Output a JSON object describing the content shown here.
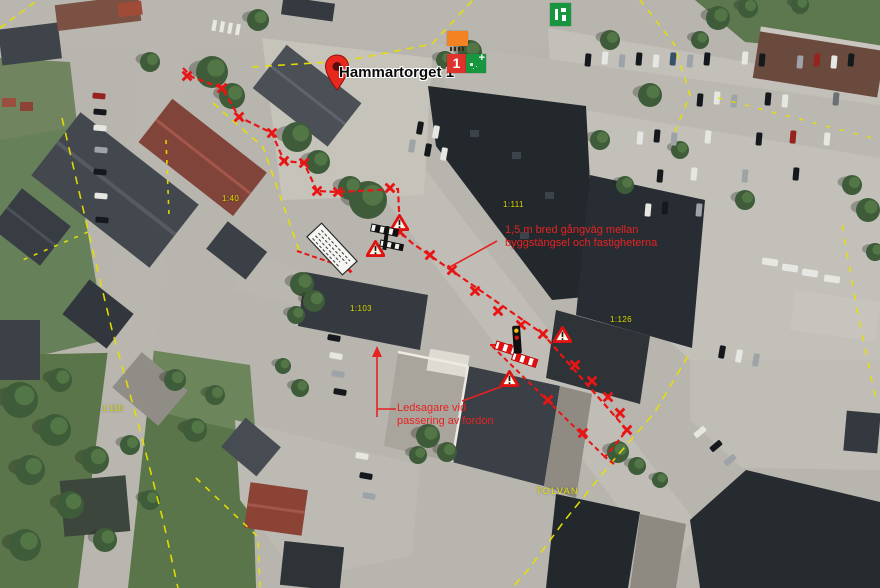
{
  "pin": {
    "label": "Hammartorget 1"
  },
  "notes": {
    "walkway": {
      "line1": "1,5 m bred gångväg mellan",
      "line2": "byggstängsel och fastigheterna"
    },
    "escort": {
      "line1": "Ledsagare vid",
      "line2": "passering av fordon"
    }
  },
  "parcels": {
    "k40": "1:40",
    "k111": "1:111",
    "k103": "1:103",
    "k126": "1:126",
    "k110": "1:110",
    "block": "TOLVAN"
  },
  "markers": {
    "cluster_count": "1",
    "expand": "+"
  },
  "colors": {
    "route_red": "#e81515",
    "note_text": "#e62222",
    "boundary_yellow": "#e6e000",
    "parcel_text": "#d9d800",
    "marker_orange": "#f58220",
    "marker_green": "#17953f",
    "marker_red": "#dd332b",
    "pin_red": "#e8281e"
  }
}
